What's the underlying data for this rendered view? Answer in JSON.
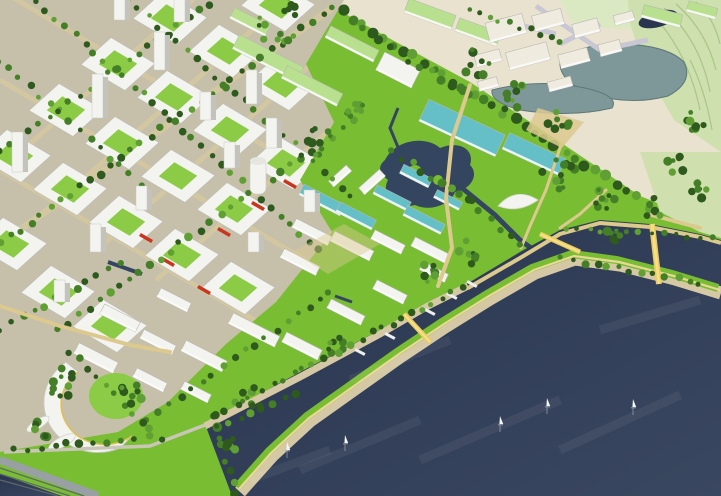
{
  "scene": {
    "palette": {
      "lakeTop": "#2a3650",
      "lakeBottom": "#3a4760",
      "parkGreen": "#79bd33",
      "courtGreen": "#8ccb45",
      "urbanBase": "#c6c0aa",
      "industrialBase": "#e9e2cf",
      "hills": "#cde0ae",
      "fields": "#dbe9c2",
      "paleRight": "#cfe0ae",
      "lagoon": "#7e9899",
      "forest": "#33591f",
      "buildingWhite": "#f3f3ef",
      "buildingSide": "#c3c3bc",
      "roofGreen": "#b8e08f",
      "tealGlass": "#64bfc7",
      "cream": "#efebdf",
      "streetTan": "#d2c7a0",
      "pathTan": "#dcc98e",
      "beach": "#d5c8a5",
      "promenade": "#ead896",
      "bridgeYellow": "#eccb5e",
      "boardwalk": "#99a0a4",
      "lawnWalk": "#c9c6b8",
      "redAccent": "#c8361f",
      "treeDark": "#2e5a1e",
      "treeMid": "#447f27",
      "treeLight": "#5f9f33",
      "streamBlue": "#34465f",
      "roadLavender": "#c9c7d3"
    },
    "water": {
      "boats": [
        [
          287,
          450
        ],
        [
          345,
          443
        ],
        [
          500,
          424
        ],
        [
          547,
          406
        ],
        [
          633,
          407
        ]
      ],
      "streaks": [
        [
          300,
          470,
          420,
          420
        ],
        [
          420,
          460,
          560,
          400
        ],
        [
          560,
          450,
          680,
          395
        ],
        [
          250,
          480,
          330,
          450
        ],
        [
          600,
          330,
          700,
          300
        ],
        [
          350,
          380,
          450,
          340
        ]
      ]
    },
    "urban": {
      "streets": [
        [
          44,
          214,
          310,
          -21
        ],
        [
          100,
          247,
          366,
          17
        ],
        [
          156,
          280,
          422,
          50
        ],
        [
          -12,
          181,
          248,
          -49
        ],
        [
          0,
          -10,
          380,
          214
        ],
        [
          0,
          80,
          380,
          304
        ],
        [
          0,
          170,
          300,
          347
        ],
        [
          0,
          244,
          332,
          8,
          7
        ]
      ],
      "blocks": [
        [
          14,
          156
        ],
        [
          66,
          110
        ],
        [
          118,
          64
        ],
        [
          170,
          18
        ],
        [
          70,
          189
        ],
        [
          122,
          143
        ],
        [
          174,
          97
        ],
        [
          226,
          51
        ],
        [
          278,
          5
        ],
        [
          126,
          222
        ],
        [
          178,
          176
        ],
        [
          230,
          130
        ],
        [
          282,
          84
        ],
        [
          182,
          255
        ],
        [
          234,
          209
        ],
        [
          286,
          163
        ],
        [
          10,
          244
        ],
        [
          58,
          292
        ],
        [
          110,
          326
        ],
        [
          238,
          288
        ]
      ],
      "redBlocks": [
        [
          168,
          262
        ],
        [
          224,
          232
        ],
        [
          258,
          206
        ],
        [
          290,
          184
        ],
        [
          204,
          290
        ],
        [
          146,
          238
        ]
      ],
      "towers": [
        [
          18,
          172,
          40
        ],
        [
          98,
          118,
          44
        ],
        [
          160,
          70,
          38
        ],
        [
          252,
          104,
          34
        ],
        [
          272,
          148,
          30
        ],
        [
          230,
          168,
          26
        ],
        [
          180,
          22,
          30
        ],
        [
          96,
          252,
          28
        ],
        [
          142,
          210,
          24
        ],
        [
          310,
          212,
          22
        ],
        [
          254,
          252,
          20
        ],
        [
          60,
          302,
          22
        ],
        [
          206,
          120,
          28
        ],
        [
          120,
          20,
          26
        ]
      ]
    },
    "buildings": {
      "slabs": [
        [
          268,
          58,
          72,
          16,
          27,
          "g"
        ],
        [
          312,
          86,
          62,
          14,
          27,
          "g"
        ],
        [
          352,
          44,
          54,
          13,
          27,
          "g"
        ],
        [
          250,
          22,
          40,
          12,
          27,
          "g"
        ],
        [
          430,
          14,
          50,
          15,
          20,
          "g"
        ],
        [
          478,
          32,
          44,
          14,
          20,
          "g"
        ],
        [
          398,
          70,
          40,
          20,
          27,
          "w"
        ],
        [
          462,
          128,
          84,
          24,
          25,
          "t"
        ],
        [
          534,
          154,
          62,
          18,
          25,
          "t"
        ],
        [
          662,
          16,
          40,
          13,
          15,
          "g"
        ],
        [
          702,
          10,
          30,
          11,
          15,
          "g"
        ],
        [
          322,
          200,
          46,
          12,
          27,
          "t"
        ],
        [
          356,
          216,
          40,
          11,
          27,
          "t"
        ],
        [
          392,
          198,
          38,
          10,
          27,
          "t"
        ],
        [
          424,
          220,
          42,
          11,
          27,
          "t"
        ],
        [
          416,
          176,
          32,
          10,
          27,
          "t"
        ],
        [
          448,
          200,
          28,
          9,
          27,
          "t"
        ],
        [
          312,
          232,
          40,
          10,
          27,
          "w"
        ],
        [
          352,
          246,
          44,
          11,
          27,
          "w"
        ],
        [
          388,
          242,
          34,
          10,
          27,
          "w"
        ],
        [
          430,
          250,
          38,
          10,
          27,
          "w"
        ],
        [
          372,
          182,
          28,
          9,
          -42,
          "w"
        ],
        [
          340,
          176,
          24,
          8,
          -42,
          "w"
        ],
        [
          300,
          262,
          40,
          10,
          27,
          "w"
        ],
        [
          254,
          330,
          52,
          12,
          27,
          "w"
        ],
        [
          302,
          346,
          40,
          11,
          27,
          "w"
        ],
        [
          204,
          356,
          46,
          12,
          27,
          "w"
        ],
        [
          158,
          342,
          36,
          10,
          27,
          "w"
        ],
        [
          346,
          312,
          38,
          10,
          27,
          "w"
        ],
        [
          390,
          292,
          34,
          10,
          27,
          "w"
        ],
        [
          434,
          272,
          28,
          9,
          27,
          "w"
        ],
        [
          120,
          318,
          40,
          11,
          27,
          "w"
        ],
        [
          174,
          300,
          34,
          10,
          27,
          "w"
        ],
        [
          96,
          358,
          44,
          12,
          27,
          "w"
        ],
        [
          150,
          380,
          34,
          10,
          27,
          "w"
        ],
        [
          196,
          392,
          30,
          9,
          27,
          "w"
        ],
        [
          506,
          28,
          38,
          20,
          -15,
          "c"
        ],
        [
          548,
          20,
          30,
          16,
          -15,
          "c"
        ],
        [
          586,
          28,
          26,
          14,
          -15,
          "c"
        ],
        [
          528,
          56,
          42,
          18,
          -15,
          "c"
        ],
        [
          574,
          58,
          30,
          14,
          -15,
          "c"
        ],
        [
          610,
          48,
          22,
          12,
          -15,
          "c"
        ],
        [
          488,
          58,
          26,
          12,
          -15,
          "c"
        ],
        [
          624,
          18,
          20,
          10,
          -15,
          "c"
        ],
        [
          560,
          84,
          24,
          10,
          -15,
          "c"
        ],
        [
          488,
          84,
          20,
          10,
          -15,
          "c"
        ]
      ]
    },
    "trees": {
      "urbanLines": [
        [
          0,
          244,
          332,
          8,
          34,
          3.2
        ],
        [
          0,
          152,
          208,
          4,
          22,
          3
        ],
        [
          58,
          330,
          352,
          122,
          30,
          3.2
        ],
        [
          148,
          418,
          330,
          292,
          18,
          3
        ],
        [
          36,
          0,
          320,
          250,
          30,
          3
        ],
        [
          128,
          0,
          352,
          196,
          24,
          3
        ],
        [
          0,
          60,
          150,
          192,
          16,
          3
        ],
        [
          0,
          330,
          120,
          262,
          12,
          3
        ],
        [
          342,
          12,
          636,
          196,
          30,
          4.2
        ],
        [
          360,
          30,
          470,
          96,
          12,
          3.6
        ],
        [
          470,
          10,
          560,
          40,
          10,
          2.6
        ]
      ],
      "waterLines": [
        [
          214,
          416,
          236,
          492,
          8,
          3.6
        ],
        [
          214,
          414,
          462,
          288,
          26,
          3.2
        ],
        [
          562,
          258,
          700,
          282,
          13,
          3
        ],
        [
          566,
          228,
          712,
          238,
          13,
          2.4
        ],
        [
          392,
          152,
          470,
          202,
          9,
          3.6
        ],
        [
          470,
          202,
          522,
          246,
          6,
          3.2
        ],
        [
          14,
          450,
          148,
          437,
          11,
          3.2
        ],
        [
          216,
          428,
          298,
          392,
          8,
          3.4
        ],
        [
          70,
          352,
          160,
          438,
          11,
          3
        ]
      ],
      "clusters": [
        [
          318,
          142,
          16,
          10
        ],
        [
          356,
          108,
          13,
          8
        ],
        [
          476,
          62,
          15,
          9
        ],
        [
          516,
          100,
          16,
          10
        ],
        [
          558,
          172,
          18,
          12
        ],
        [
          606,
          198,
          14,
          9
        ],
        [
          652,
          208,
          12,
          8
        ],
        [
          470,
          252,
          12,
          7
        ],
        [
          432,
          272,
          11,
          7
        ],
        [
          336,
          348,
          11,
          7
        ],
        [
          250,
          398,
          13,
          8
        ],
        [
          62,
          382,
          16,
          10
        ],
        [
          132,
          392,
          12,
          8
        ],
        [
          40,
          430,
          10,
          6
        ],
        [
          228,
          444,
          9,
          6
        ],
        [
          676,
          162,
          12,
          8
        ],
        [
          700,
          192,
          10,
          6
        ],
        [
          694,
          120,
          11,
          7
        ],
        [
          560,
          120,
          13,
          8
        ],
        [
          610,
          236,
          10,
          6
        ],
        [
          282,
          20,
          28,
          16
        ]
      ]
    },
    "waterfront": {
      "bridges": [
        [
          540,
          234,
          580,
          252,
          5
        ],
        [
          652,
          224,
          659,
          284,
          6
        ],
        [
          404,
          314,
          430,
          342,
          5
        ]
      ],
      "jetties": [
        [
          452,
          296,
          28
        ],
        [
          430,
          312,
          28
        ],
        [
          472,
          284,
          28
        ],
        [
          360,
          352,
          28
        ],
        [
          390,
          336,
          28
        ]
      ]
    },
    "park": {
      "paths": [
        {
          "pts": "470,85 452,140 446,198 452,248 438,286",
          "w": 4
        },
        {
          "pts": "562,142 546,190 530,226 521,248",
          "w": 3
        },
        {
          "pts": "606,190 580,214 560,228",
          "w": 3
        },
        {
          "pts": "0,306 60,326 130,345 170,352",
          "w": 4
        },
        {
          "pts": "648,214 700,228",
          "w": 4
        }
      ]
    }
  }
}
